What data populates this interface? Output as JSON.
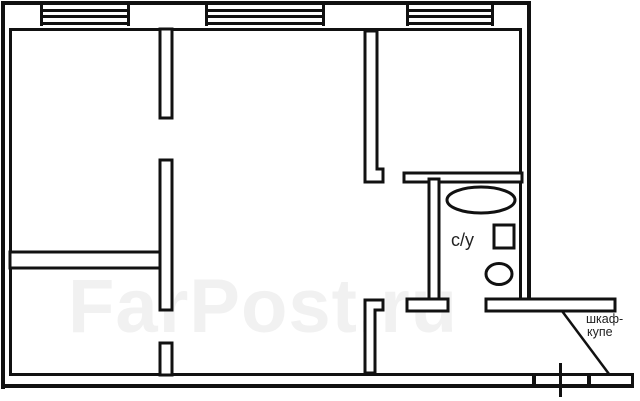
{
  "plan": {
    "type": "apartment-floor-plan",
    "labels": {
      "bathroom": "с/у",
      "wardrobe_line1": "шкаф-",
      "wardrobe_line2": "купе"
    },
    "watermark": "FarPost.ru",
    "colors": {
      "line": "#111111",
      "background": "#ffffff",
      "watermark": "#f1f1f1",
      "label": "#222222"
    },
    "icons": [
      "bathtub-ellipse",
      "appliance-square",
      "toilet-ellipse",
      "wardrobe-shelf",
      "entry-door-tick",
      "window-symbol"
    ]
  }
}
